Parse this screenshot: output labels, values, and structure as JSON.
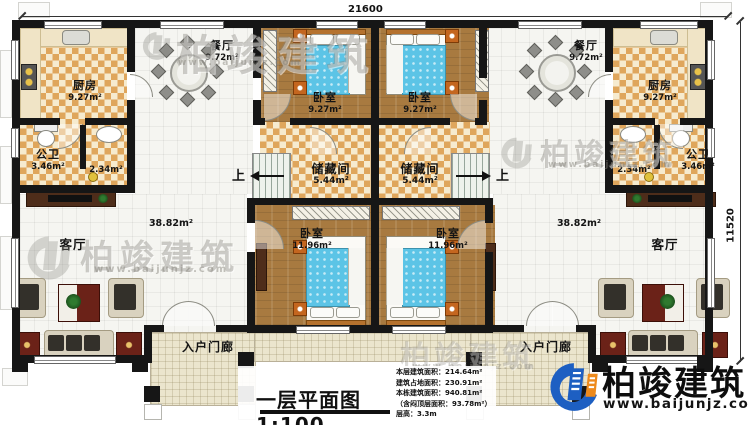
{
  "dimensions": {
    "top": "21600",
    "right": "11520"
  },
  "stairs": {
    "up": "上"
  },
  "rooms": {
    "kitchen_left": {
      "name": "厨房",
      "area": "9.27m²"
    },
    "dining_left": {
      "name": "餐厅",
      "area": "9.72m²"
    },
    "bath_left": {
      "name": "公卫",
      "area": "3.46m²"
    },
    "bath2_left": {
      "area": "2.34m²"
    },
    "living_left": {
      "name": "客厅",
      "area": "38.82m²"
    },
    "porch_left": {
      "name": "入户门廊"
    },
    "bedroom_top_left": {
      "name": "卧室",
      "area": "9.27m²"
    },
    "bedroom_top_right": {
      "name": "卧室",
      "area": "9.27m²"
    },
    "storage_left": {
      "name": "储藏间",
      "area": "5.44m²"
    },
    "storage_right": {
      "name": "储藏间",
      "area": "5.44m²"
    },
    "bedroom_bottom_left": {
      "name": "卧室",
      "area": "11.96m²"
    },
    "bedroom_bottom_right": {
      "name": "卧室",
      "area": "11.96m²"
    },
    "kitchen_right": {
      "name": "厨房",
      "area": "9.27m²"
    },
    "dining_right": {
      "name": "餐厅",
      "area": "9.72m²"
    },
    "bath_right": {
      "name": "公卫",
      "area": "3.46m²"
    },
    "bath2_right": {
      "area": "2.34m²"
    },
    "living_right": {
      "name": "客厅",
      "area": "38.82m²"
    },
    "porch_right": {
      "name": "入户门廊"
    }
  },
  "title": {
    "text": "一层平面图1:100"
  },
  "info": {
    "lines": [
      "本层建筑面积：214.64m²",
      "建筑占地面积：230.91m²",
      "本栋建筑面积：940.81m²",
      "（含闷顶层面积：93.78m²）",
      "层高：3.3m"
    ]
  },
  "brand": {
    "name": "柏竣建筑",
    "website": "www.baijunjz.com",
    "blue": "#1d5fc2",
    "orange": "#ee8a1c"
  },
  "watermark": {
    "text": "柏竣建筑",
    "website": "www.baijunjz.com"
  }
}
